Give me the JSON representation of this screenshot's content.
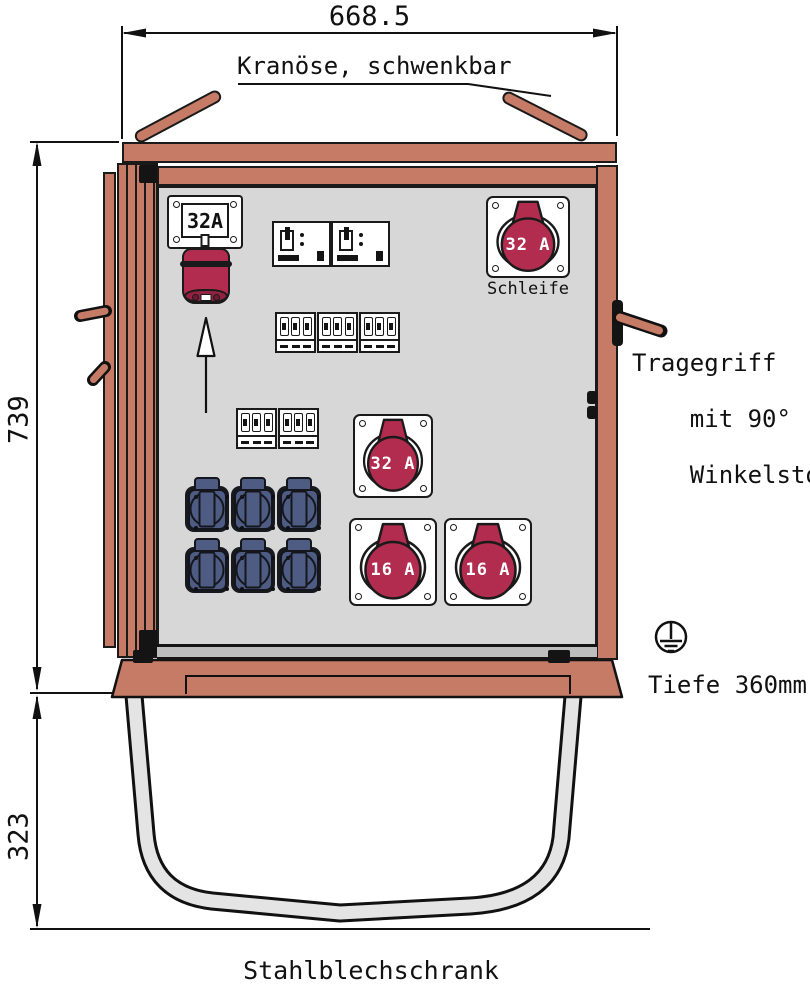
{
  "drawing": {
    "dim_width": "668.5",
    "dim_height": "739",
    "dim_stand_height": "323",
    "depth_note": "Tiefe 360mm",
    "crane_label": "Kranöse, schwenkbar",
    "handle_label_lines": [
      "Tragegriff",
      "mit 90°",
      "Winkelstopp"
    ],
    "cabinet_label": "Stahlblechschrank"
  },
  "components": {
    "inlet_rating": "32A",
    "loop_socket": {
      "rating": "32 A",
      "name": "Schleife"
    },
    "socket_32a_rating": "32 A",
    "socket_16a_left_rating": "16 A",
    "socket_16a_right_rating": "16 A",
    "schuko_socket_count": 6,
    "rcd_count": 2,
    "mcb_groups_row1": 3,
    "mcb_groups_row2": 2
  },
  "colors": {
    "frame_salmon": "#C57B66",
    "cee_red": "#B12C4E",
    "schuko_blue": "#4E5C84",
    "panel_gray": "#D7D7D7",
    "line_black": "#1a1a1a"
  }
}
